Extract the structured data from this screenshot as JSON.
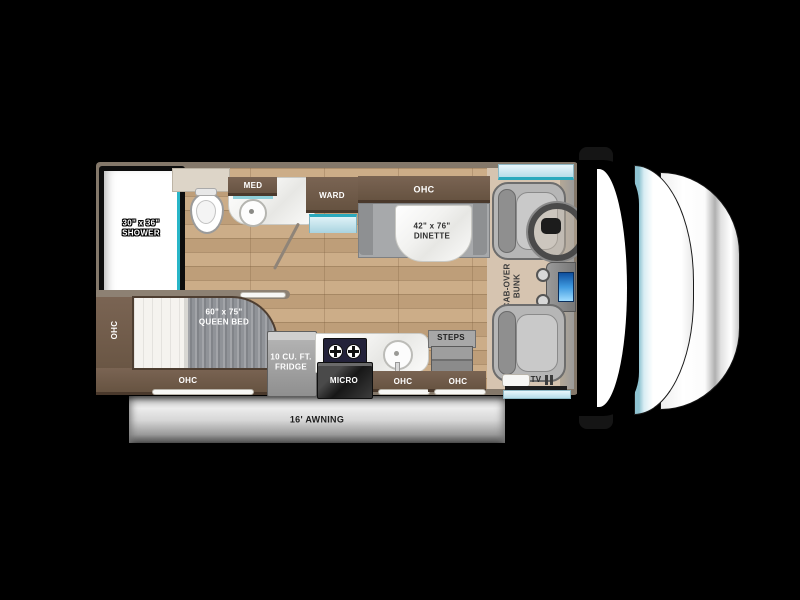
{
  "diagram_type": "rv-motorhome-floorplan",
  "colors": {
    "background": "#000000",
    "accent_teal": "#2aa9bd",
    "window_blue": "#cdeaf2",
    "wall_gray_brown": "#84786a",
    "cabinet_brown": "#6b5848",
    "wood_floor": "#c8a77f",
    "cab_floor_tan": "#d6c4b0",
    "awning_silver": "#c9c9c9",
    "cooktop_navy": "#23223a"
  },
  "labels": {
    "ohc": "OHC",
    "med": "MED",
    "ward": "WARD",
    "steps": "STEPS",
    "micro": "MICRO",
    "tv": "TV",
    "awning": "16' AWNING",
    "shower": {
      "size": "30\" x 36\"",
      "name": "SHOWER"
    },
    "dinette": {
      "size": "42\" x 76\"",
      "name": "DINETTE"
    },
    "queen_bed": {
      "size": "60\" x 75\"",
      "name": "QUEEN BED"
    },
    "fridge": {
      "line1": "10 CU. FT.",
      "line2": "FRIDGE"
    },
    "cabover_bunk": {
      "line1": "CAB-OVER",
      "line2": "BUNK"
    }
  }
}
